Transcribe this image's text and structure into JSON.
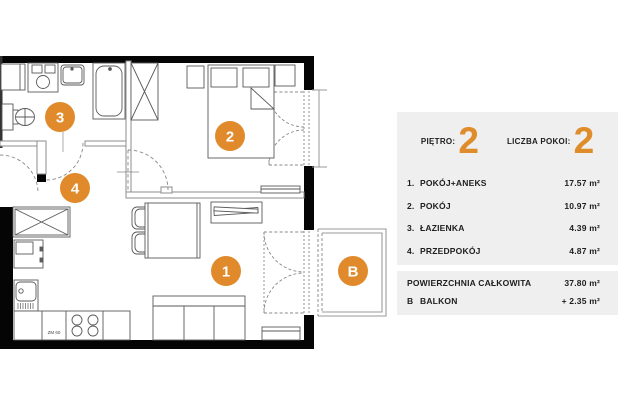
{
  "panel": {
    "floor_label": "PIĘTRO:",
    "floor_value": "2",
    "rooms_count_label": "LICZBA POKOI:",
    "rooms_count_value": "2",
    "rows": [
      {
        "num": "1.",
        "name": "POKÓJ+ANEKS",
        "area": "17.57 m²"
      },
      {
        "num": "2.",
        "name": "POKÓJ",
        "area": "10.97 m²"
      },
      {
        "num": "3.",
        "name": "ŁAZIENKA",
        "area": "4.39 m²"
      },
      {
        "num": "4.",
        "name": "PRZEDPOKÓJ",
        "area": "4.87 m²"
      }
    ],
    "total_label": "POWIERZCHNIA CAŁKOWITA",
    "total_area": "37.80 m²",
    "balcony_num": "B",
    "balcony_label": "BALKON",
    "balcony_area": "+ 2.35 m²"
  },
  "plan": {
    "markers": {
      "room1": "1",
      "room2": "2",
      "room3": "3",
      "room4": "4",
      "balcony": "B"
    },
    "dishwasher_label": "ZM 60"
  },
  "colors": {
    "accent": "#E08A2C",
    "panel_bg": "#EFEFEF",
    "wall": "#050505"
  }
}
